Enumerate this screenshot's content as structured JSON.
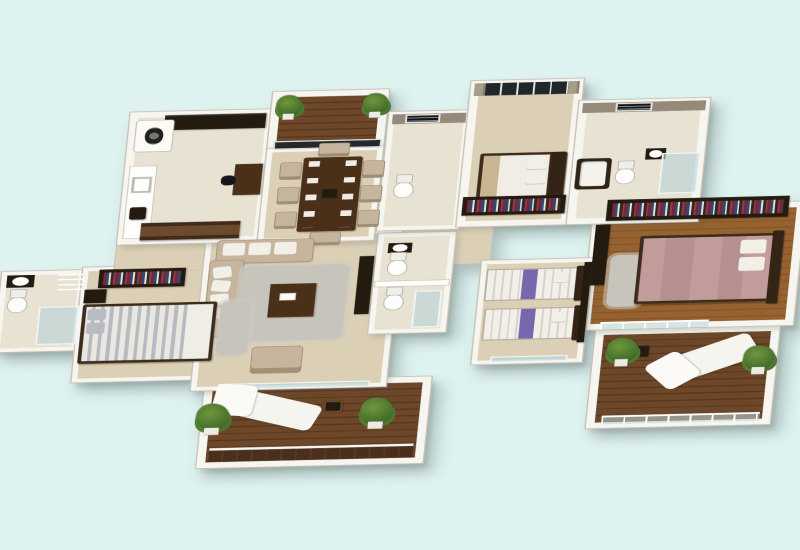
{
  "scene": {
    "type": "isometric-3d-floor-plan-render",
    "background": "#def2f0",
    "palette": {
      "bg": "#def2f0",
      "wall": "#f6f5f0",
      "wall_edge": "#c6c1b5",
      "floor_beige": "#dbd0b6",
      "floor_tile": "#e8e2d2",
      "taupe": "#95897a",
      "wood_dark": "#4a3018",
      "deck": "#55371f",
      "deck_light": "#6e4729",
      "sofa": "#c6b59c",
      "cushion": "#f2efe7",
      "rug": "#c7c4bc",
      "bed_white": "#f0ede4",
      "bed_tan": "#c9b690",
      "bed_pink": "#c29b9b",
      "purple": "#7568ac",
      "glassblue": "#b7d3d6",
      "plantgreen": "#4c7733",
      "dark": "#241b10",
      "white": "#fdfdfb"
    },
    "rooms": [
      {
        "id": "kitchen-utility",
        "label": "Kitchen and utility room",
        "items": [
          "washing machine",
          "black countertop",
          "kitchen counter",
          "sink",
          "coffee maker",
          "wood cabinet",
          "study desk",
          "desk chair"
        ]
      },
      {
        "id": "front-balcony",
        "label": "Front balcony",
        "items": [
          "wood deck",
          "potted plant",
          "potted plant",
          "glazed door"
        ]
      },
      {
        "id": "dining-room",
        "label": "Dining room",
        "items": [
          "dining table",
          "8 chairs",
          "placemats",
          "centerpiece"
        ]
      },
      {
        "id": "bathroom-2",
        "label": "Bathroom 2",
        "items": [
          "toilet",
          "louvered window"
        ]
      },
      {
        "id": "bedroom-2",
        "label": "Bedroom 2",
        "items": [
          "double bed",
          "pillows",
          "tan blanket",
          "curtained window",
          "bookshelf dresser"
        ]
      },
      {
        "id": "ensuite-bathroom",
        "label": "En-suite bathroom",
        "items": [
          "bathtub",
          "toilet",
          "washbasin",
          "glass shower",
          "louvered window"
        ]
      },
      {
        "id": "master-bedroom",
        "label": "Master bedroom",
        "items": [
          "double bed pink",
          "pillows",
          "long bookshelf",
          "tv panel",
          "rug",
          "glass railing",
          "wood floor"
        ]
      },
      {
        "id": "master-terrace",
        "label": "Master terrace",
        "items": [
          "wood deck",
          "sun lounger",
          "side table",
          "potted plant",
          "potted plant",
          "glass parapet"
        ]
      },
      {
        "id": "kids-bedroom",
        "label": "Kids bedroom",
        "items": [
          "twin bed",
          "twin bed",
          "purple runners",
          "wardrobe",
          "glass door"
        ]
      },
      {
        "id": "hall-toilets",
        "label": "Hall toilets",
        "items": [
          "washbasin",
          "toilet",
          "toilet",
          "glass shower"
        ]
      },
      {
        "id": "living-room",
        "label": "Living room",
        "items": [
          "sectional sofa",
          "white cushions",
          "shag rug",
          "coffee table",
          "armchair",
          "tv unit",
          "glass doors"
        ]
      },
      {
        "id": "bedroom-3",
        "label": "Bedroom 3",
        "items": [
          "double bed gray striped",
          "gray pillows",
          "bookshelf",
          "nightstand",
          "rug"
        ]
      },
      {
        "id": "bathroom-3",
        "label": "Bathroom 3",
        "items": [
          "washbasin",
          "toilet",
          "glass shower",
          "towel ladder"
        ]
      },
      {
        "id": "rear-balcony",
        "label": "Rear balcony",
        "items": [
          "wood deck",
          "sun lounger",
          "side table with photo",
          "potted plant",
          "potted plant",
          "wood parapet"
        ]
      }
    ]
  }
}
